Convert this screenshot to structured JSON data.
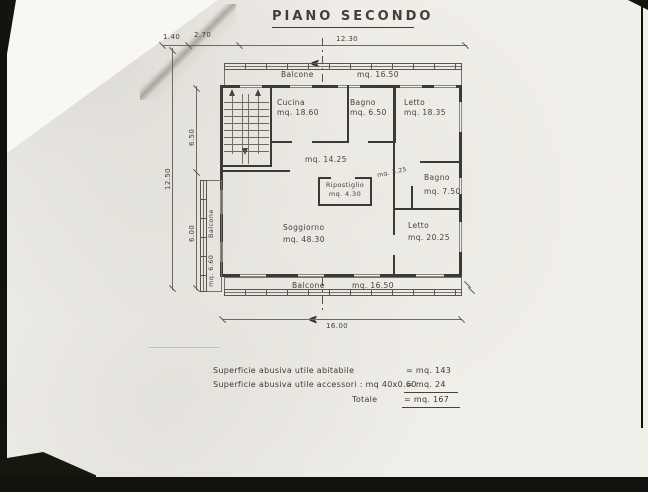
{
  "title": "PIANO SECONDO",
  "section_marker": "A",
  "dims": {
    "top_1": "1.40",
    "top_2": "2.70",
    "top_3": "12.30",
    "left_total": "12.50",
    "left_upper": "6.50",
    "left_lower": "6.00",
    "bottom_total": "16.00",
    "mid_width": "mq. 3.25"
  },
  "rooms": {
    "balcone_top": {
      "name": "Balcone",
      "area": "mq. 16.50"
    },
    "cucina": {
      "name": "Cucina",
      "area": "mq. 18.60"
    },
    "bagno_top": {
      "name": "Bagno",
      "area": "mq. 6.50"
    },
    "letto_top": {
      "name": "Letto",
      "area": "mq. 18.35"
    },
    "corridoio": {
      "area": "mq. 14.25"
    },
    "ripostiglio": {
      "name": "Ripostiglio",
      "area": "mq. 4.30"
    },
    "bagno_mid": {
      "name": "Bagno",
      "area": "mq. 7.50"
    },
    "soggiorno": {
      "name": "Soggiorno",
      "area": "mq. 48.30"
    },
    "letto_bottom": {
      "name": "Letto",
      "area": "mq. 20.25"
    },
    "balcone_bottom": {
      "name": "Balcone",
      "area": "mq. 16.50"
    },
    "balcone_left": {
      "name": "Balcone",
      "area": "mq. 6.60"
    }
  },
  "summary": {
    "row1_label": "Superficie abusiva utile abitabile",
    "row1_value": "= mq. 143",
    "row2_label": "Superficie abusiva utile accessori : mq 40x0.60",
    "row2_value": "= mq. 24",
    "total_label": "Totale",
    "total_value": "= mq. 167"
  },
  "colors": {
    "ink": "#3c3a34",
    "paper": "#f1efe9"
  }
}
